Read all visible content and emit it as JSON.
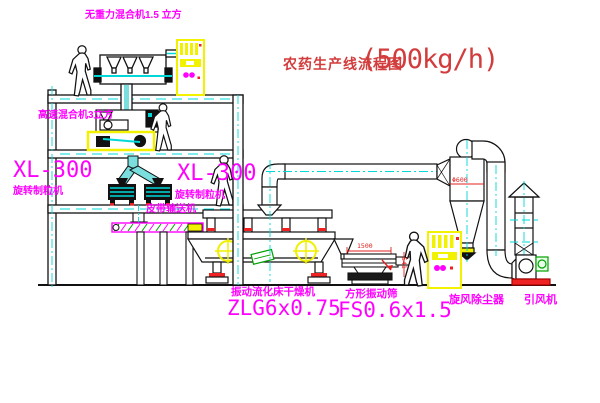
{
  "title": {
    "text": "农药生产线流程图",
    "capacity": "(500kg/h)"
  },
  "equipment": {
    "gravity_mixer": {
      "label": "无重力混合机1.5 立方"
    },
    "high_speed_mixer": {
      "label": "高速混合机3立方"
    },
    "granulator_left": {
      "model": "XL-300",
      "label": "旋转制粒机"
    },
    "granulator_right": {
      "model": "XL-300",
      "label": "旋转制粒机"
    },
    "belt_conveyor": {
      "label": "皮带输送机"
    },
    "fluid_bed_dryer": {
      "label": "振动流化床干燥机",
      "model": "ZLG6x0.75"
    },
    "vibrating_screen": {
      "label": "方形振动筛",
      "model": "FS0.6x1.5",
      "dim_width": "1500",
      "dim_height": "541"
    },
    "cyclone": {
      "label": "旋风除尘器",
      "dim": "Φ600"
    },
    "fan": {
      "label": "引风机"
    }
  },
  "colors": {
    "label_magenta": "#ff00ff",
    "title_red": "#d23c3c",
    "line": "#1a1a1a",
    "centerline_cyan": "#00d8d8",
    "highlight_yellow": "#f2f200",
    "hatch_green": "#00a000",
    "detail_red": "#ee2222"
  }
}
